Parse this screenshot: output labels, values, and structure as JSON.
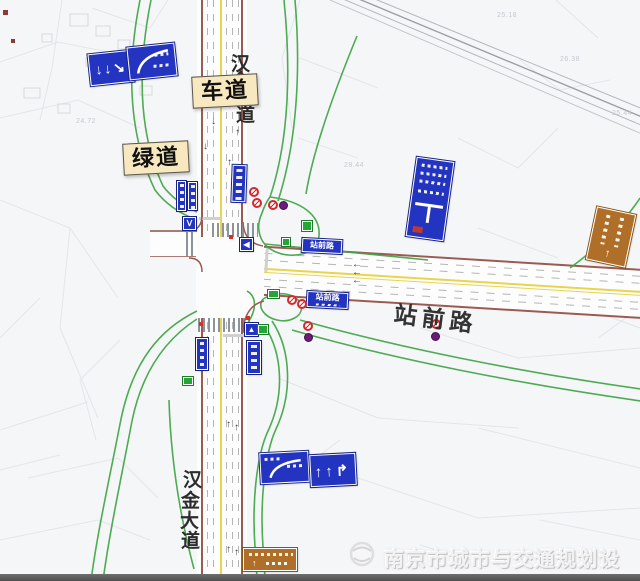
{
  "callouts": {
    "lane": "车道",
    "greenway": "绿道"
  },
  "road_labels": {
    "east": "站前路",
    "north_chars": [
      "汉",
      "金",
      "大",
      "道"
    ],
    "south_chars": [
      "汉",
      "金",
      "大",
      "道"
    ]
  },
  "street_signs": {
    "north": "站前路",
    "south": "站前路"
  },
  "sign_glyphs": {
    "nw_arrows": "↓↓↘",
    "sw_arrows": "↑↑↱",
    "left_arrow": "◀",
    "v_sign": "Ⅴ",
    "ped": "▲",
    "up_arrow": "↑"
  },
  "lane_marks": {
    "up": "↑",
    "down": "↓",
    "left": "←"
  },
  "elevations": [
    "25.18",
    "26.38",
    "28.44",
    "25.44",
    "26.55",
    "24.72"
  ],
  "footer": {
    "org": "南京市城市与交通规划设计研究院"
  },
  "colors": {
    "greenway": "#3fa544",
    "road_edge": "#9a5b52",
    "center_line": "#e8d44d",
    "sign_blue": "#2334c0",
    "sign_brown": "#b06f28",
    "callout_bg": "#f7e8c0"
  }
}
